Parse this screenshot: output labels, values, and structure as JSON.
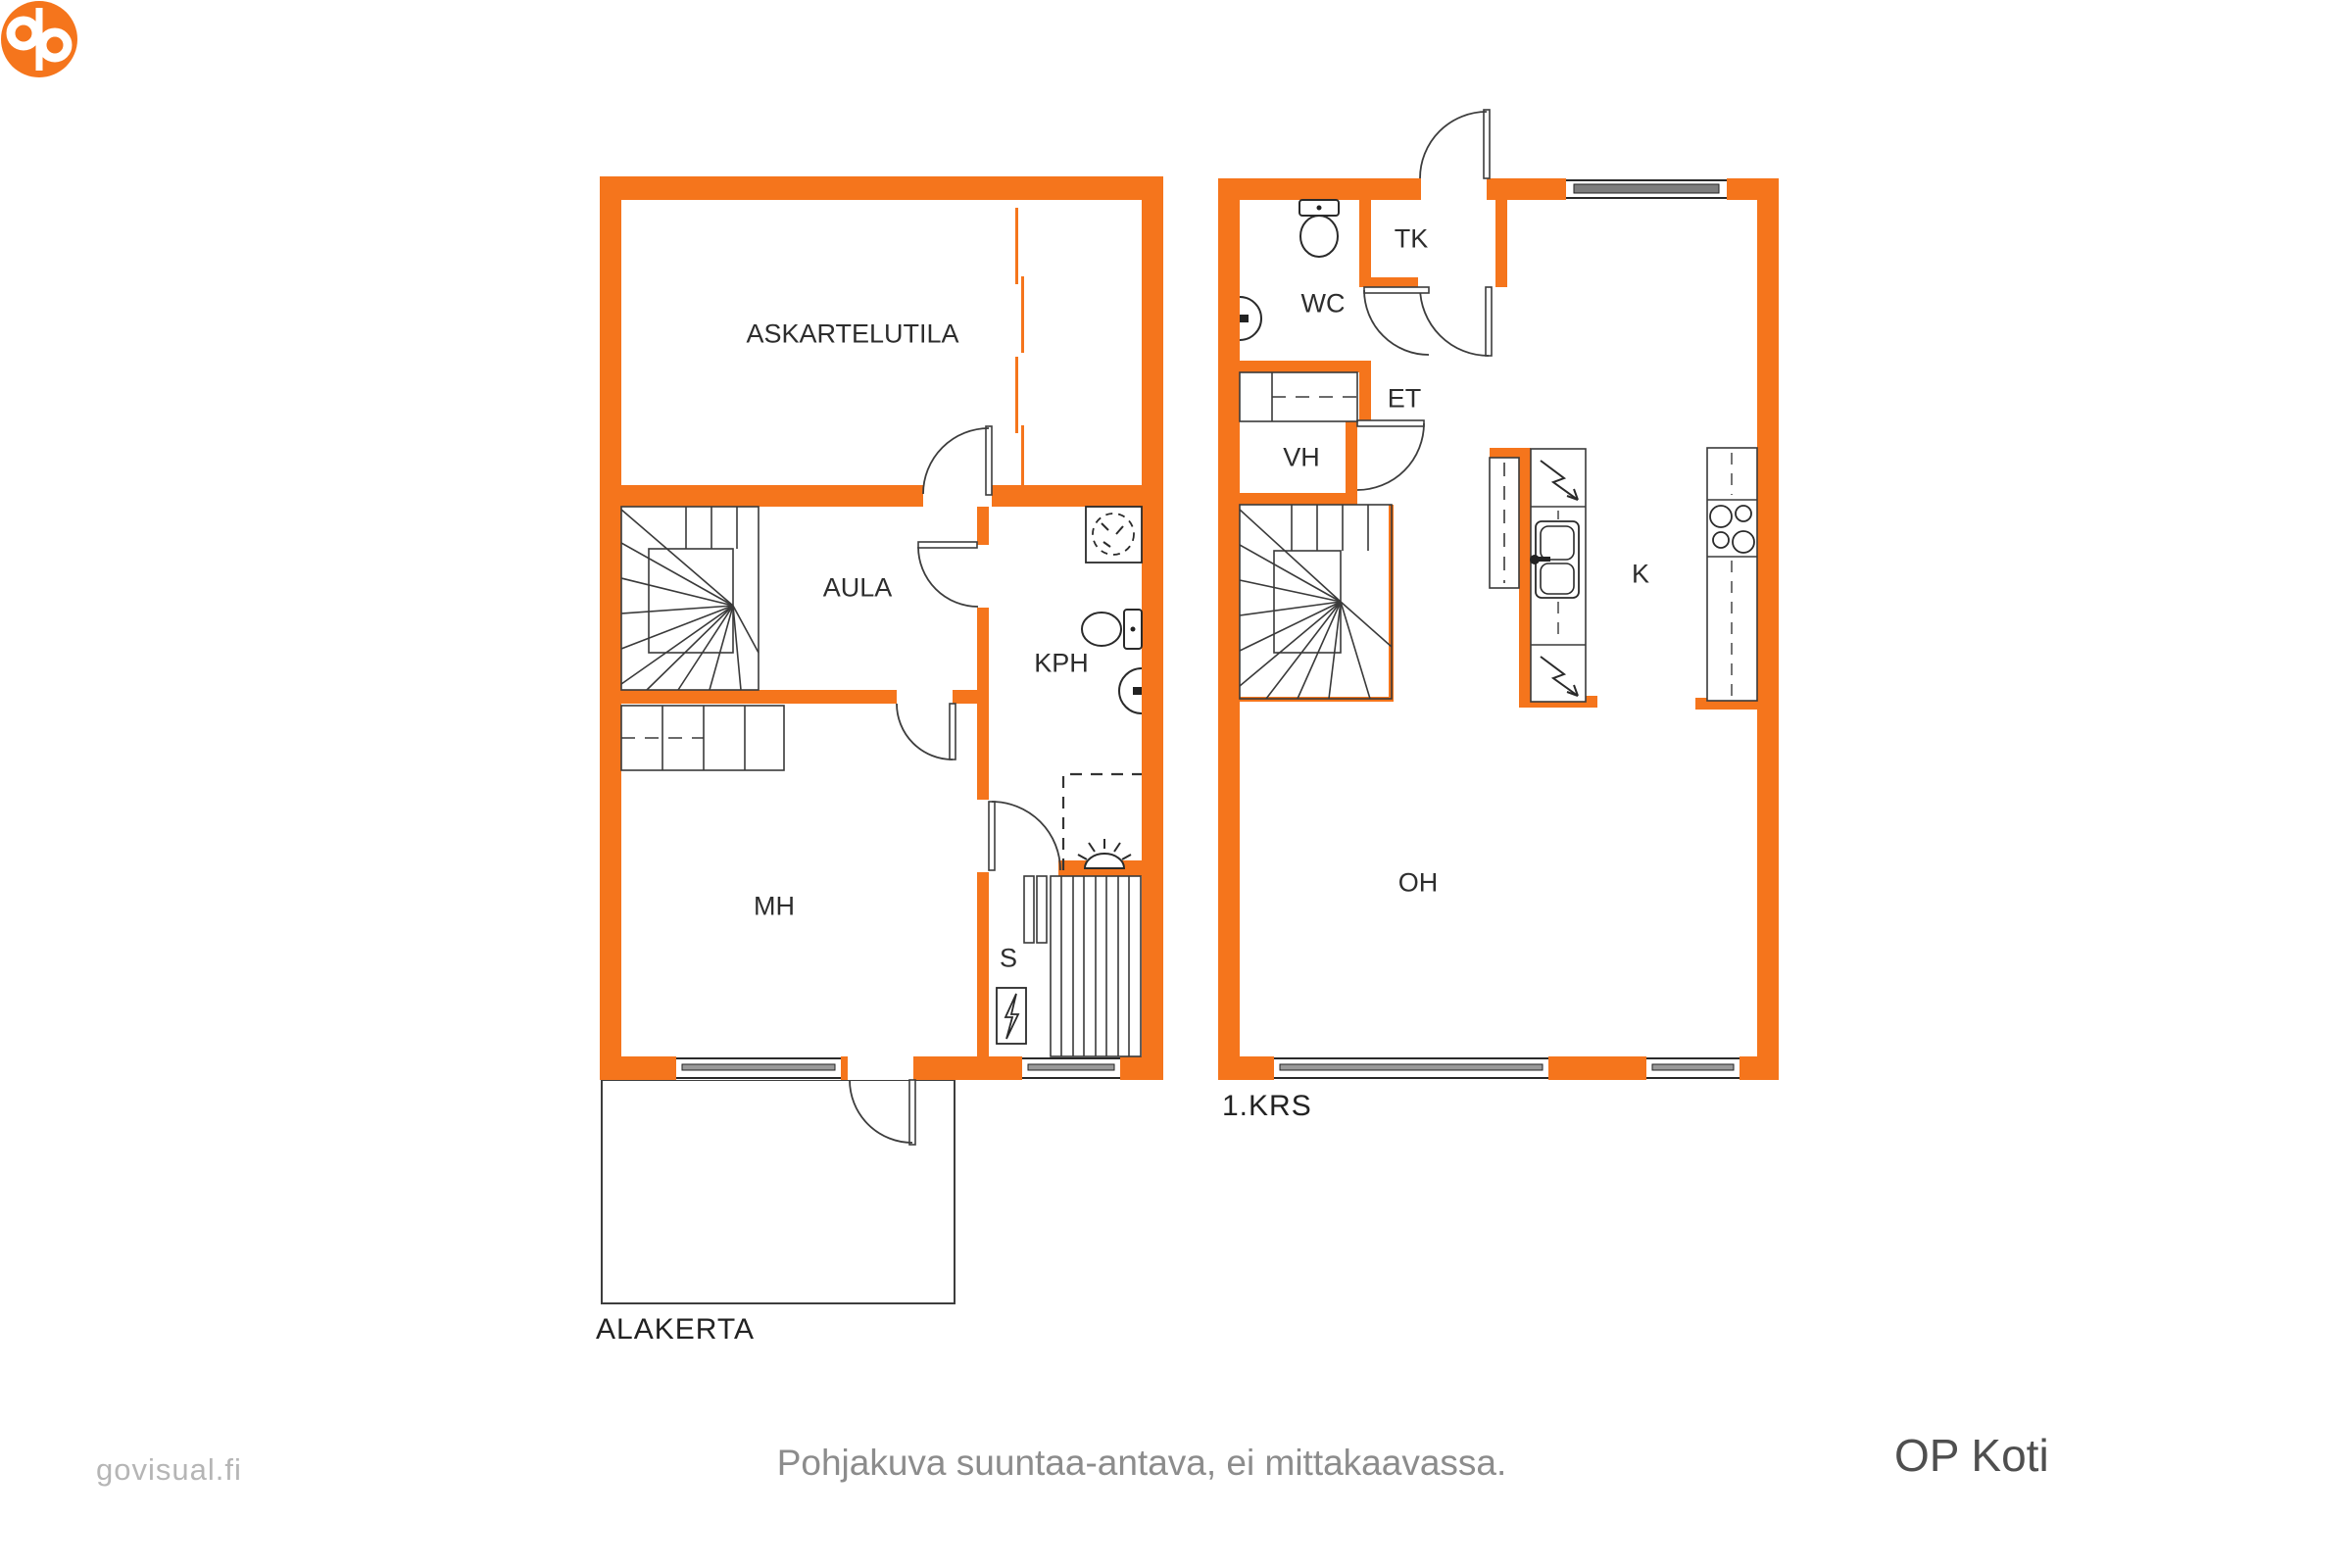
{
  "colors": {
    "wall_orange": "#F5751C",
    "line_dark": "#3d3d3d",
    "window_glass": "#7d7d7d",
    "watermark_gray": "#b5b5b5",
    "footer_gray": "#8c8c8c",
    "brand_gray": "#4f4f4f",
    "brand_orange": "#F5751C"
  },
  "plans": {
    "alakerta": {
      "title": "ALAKERTA",
      "rooms": [
        {
          "id": "askartelutila",
          "label": "ASKARTELUTILA"
        },
        {
          "id": "aula",
          "label": "AULA"
        },
        {
          "id": "kph",
          "label": "KPH"
        },
        {
          "id": "mh",
          "label": "MH"
        },
        {
          "id": "s",
          "label": "S"
        }
      ]
    },
    "krs1": {
      "title": "1.KRS",
      "rooms": [
        {
          "id": "wc",
          "label": "WC"
        },
        {
          "id": "tk",
          "label": "TK"
        },
        {
          "id": "et",
          "label": "ET"
        },
        {
          "id": "vh",
          "label": "VH"
        },
        {
          "id": "k",
          "label": "K"
        },
        {
          "id": "oh",
          "label": "OH"
        }
      ]
    }
  },
  "footer": {
    "watermark": "govisual.fi",
    "disclaimer": "Pohjakuva suuntaa-antava, ei mittakaavassa.",
    "brand": "OP Koti"
  }
}
